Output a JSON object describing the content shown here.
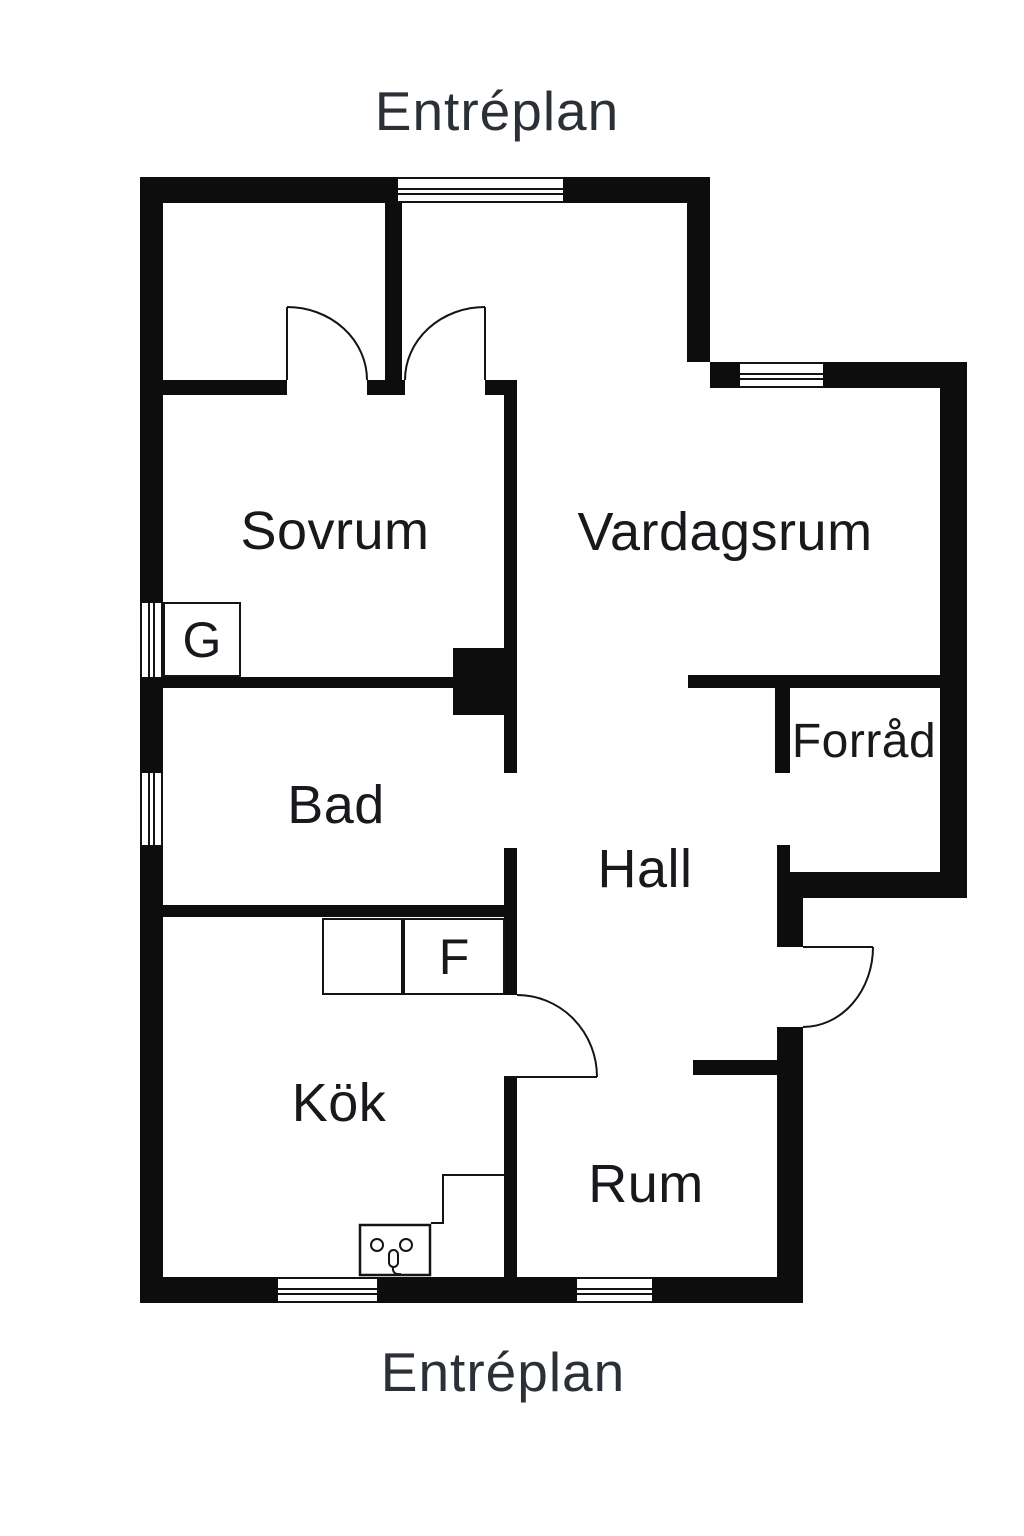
{
  "titles": {
    "top": "Entréplan",
    "bottom": "Entréplan"
  },
  "rooms": [
    {
      "name": "Sovrum"
    },
    {
      "name": "Vardagsrum"
    },
    {
      "name": "Bad"
    },
    {
      "name": "Hall"
    },
    {
      "name": "Forråd"
    },
    {
      "name": "Kök"
    },
    {
      "name": "Rum"
    }
  ],
  "fixtures": [
    {
      "label": "G"
    },
    {
      "label": "F"
    }
  ],
  "colors": {
    "wall": "#0d0d0d",
    "line": "#141414",
    "room_label": "#17191d",
    "title": "#2b2f36",
    "background": "#ffffff"
  }
}
